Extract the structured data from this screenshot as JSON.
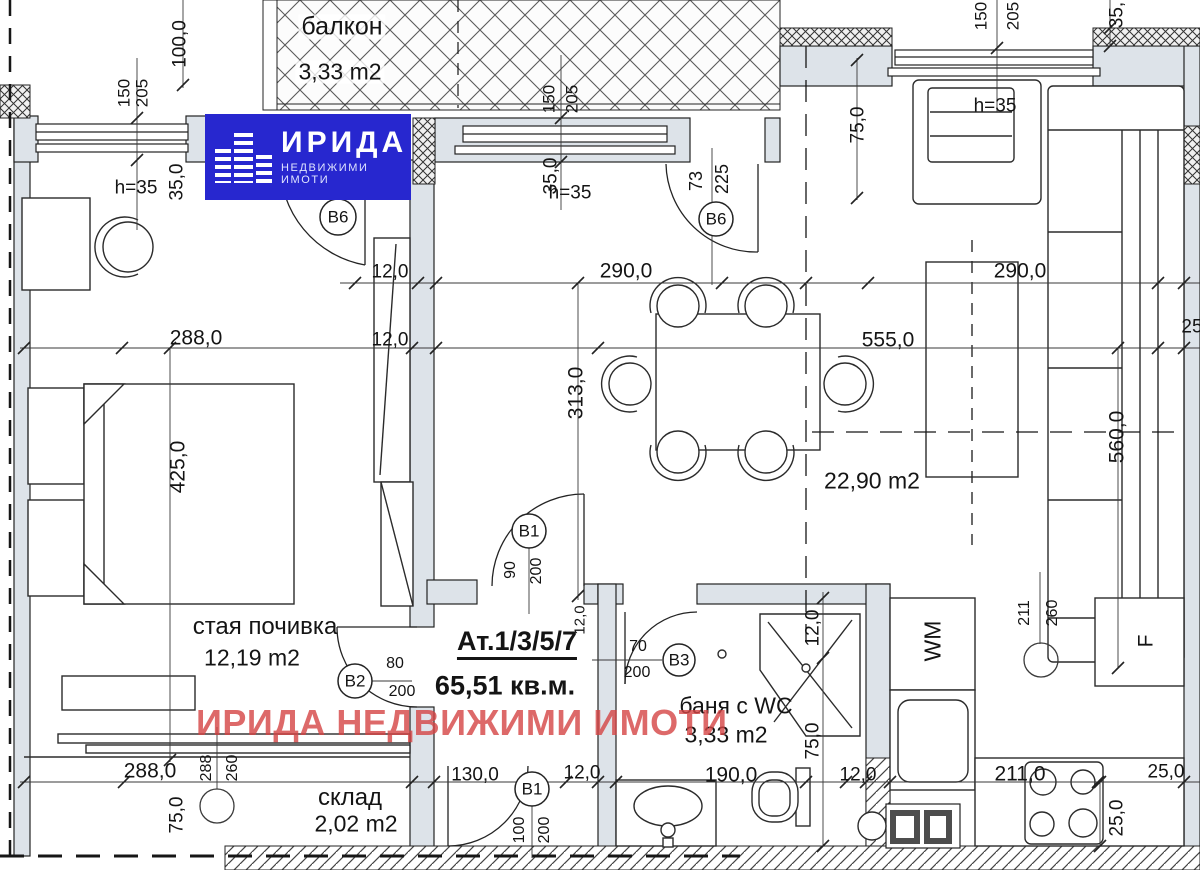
{
  "logo": {
    "brand": "ИРИДА",
    "tagline": "НЕДВИЖИМИ ИМОТИ",
    "bg_color": "#2727cf",
    "text_color": "#ffffff"
  },
  "watermark": {
    "text": "ИРИДА НЕДВИЖИМИ ИМОТИ",
    "color": "#d54444"
  },
  "unit": {
    "title": "Ат.1/3/5/7",
    "total_area": "65,51 кв.м."
  },
  "rooms": {
    "balcony": {
      "name": "балкон",
      "area": "3,33 m2"
    },
    "bedroom": {
      "name": "стая почивка",
      "area": "12,19 m2"
    },
    "living": {
      "area": "22,90 m2"
    },
    "bathroom": {
      "name": "баня с WC",
      "area": "3,33 m2"
    },
    "storage": {
      "name": "склад",
      "area": "2,02 m2"
    }
  },
  "appliances": {
    "washing_machine": "WM",
    "fridge": "F"
  },
  "doors": {
    "b6_bedroom": {
      "label": "В6"
    },
    "b6_balcony": {
      "label": "В6",
      "width": "73",
      "height": "225"
    },
    "b1_entry": {
      "label": "В1",
      "width": "90",
      "height": "200"
    },
    "b2_bedroom": {
      "label": "В2",
      "width": "80",
      "height": "200"
    },
    "b3_bath": {
      "label": "В3",
      "width": "70",
      "height": "200"
    },
    "b1_storage": {
      "label": "В1",
      "width": "100",
      "height": "200"
    }
  },
  "lights": {
    "storage": {
      "width": "288",
      "height": "260"
    },
    "kitchen": {
      "width": "211",
      "height": "260"
    }
  },
  "windows": {
    "left": {
      "width": "150",
      "sill": "205",
      "note": "h=35",
      "parapet": "35,0"
    },
    "top": {
      "width": "150",
      "sill": "205",
      "note": "h=35",
      "parapet": "35,0"
    },
    "right": {
      "width": "150",
      "sill": "205",
      "note": "h=35",
      "parapet": "35,"
    }
  },
  "dims": {
    "balcony_side": "100,0",
    "top_right_75": "75,0",
    "w12_a": "12,0",
    "w290_a": "290,0",
    "w290_b": "290,0",
    "w288_a": "288,0",
    "w12_b": "12,0",
    "w555": "555,0",
    "w25_r": "25",
    "h425": "425,0",
    "h313": "313,0",
    "h560": "560,0",
    "entry_12": "12,0",
    "bath_12": "12,0",
    "bath_75": "75,0",
    "w288_b": "288,0",
    "h75_b": "75,0",
    "w130": "130,0",
    "w12_c": "12,0",
    "w190": "190,0",
    "w12_d": "12,0",
    "w211": "211,0",
    "w25_a": "25,0",
    "h25": "25,0"
  }
}
